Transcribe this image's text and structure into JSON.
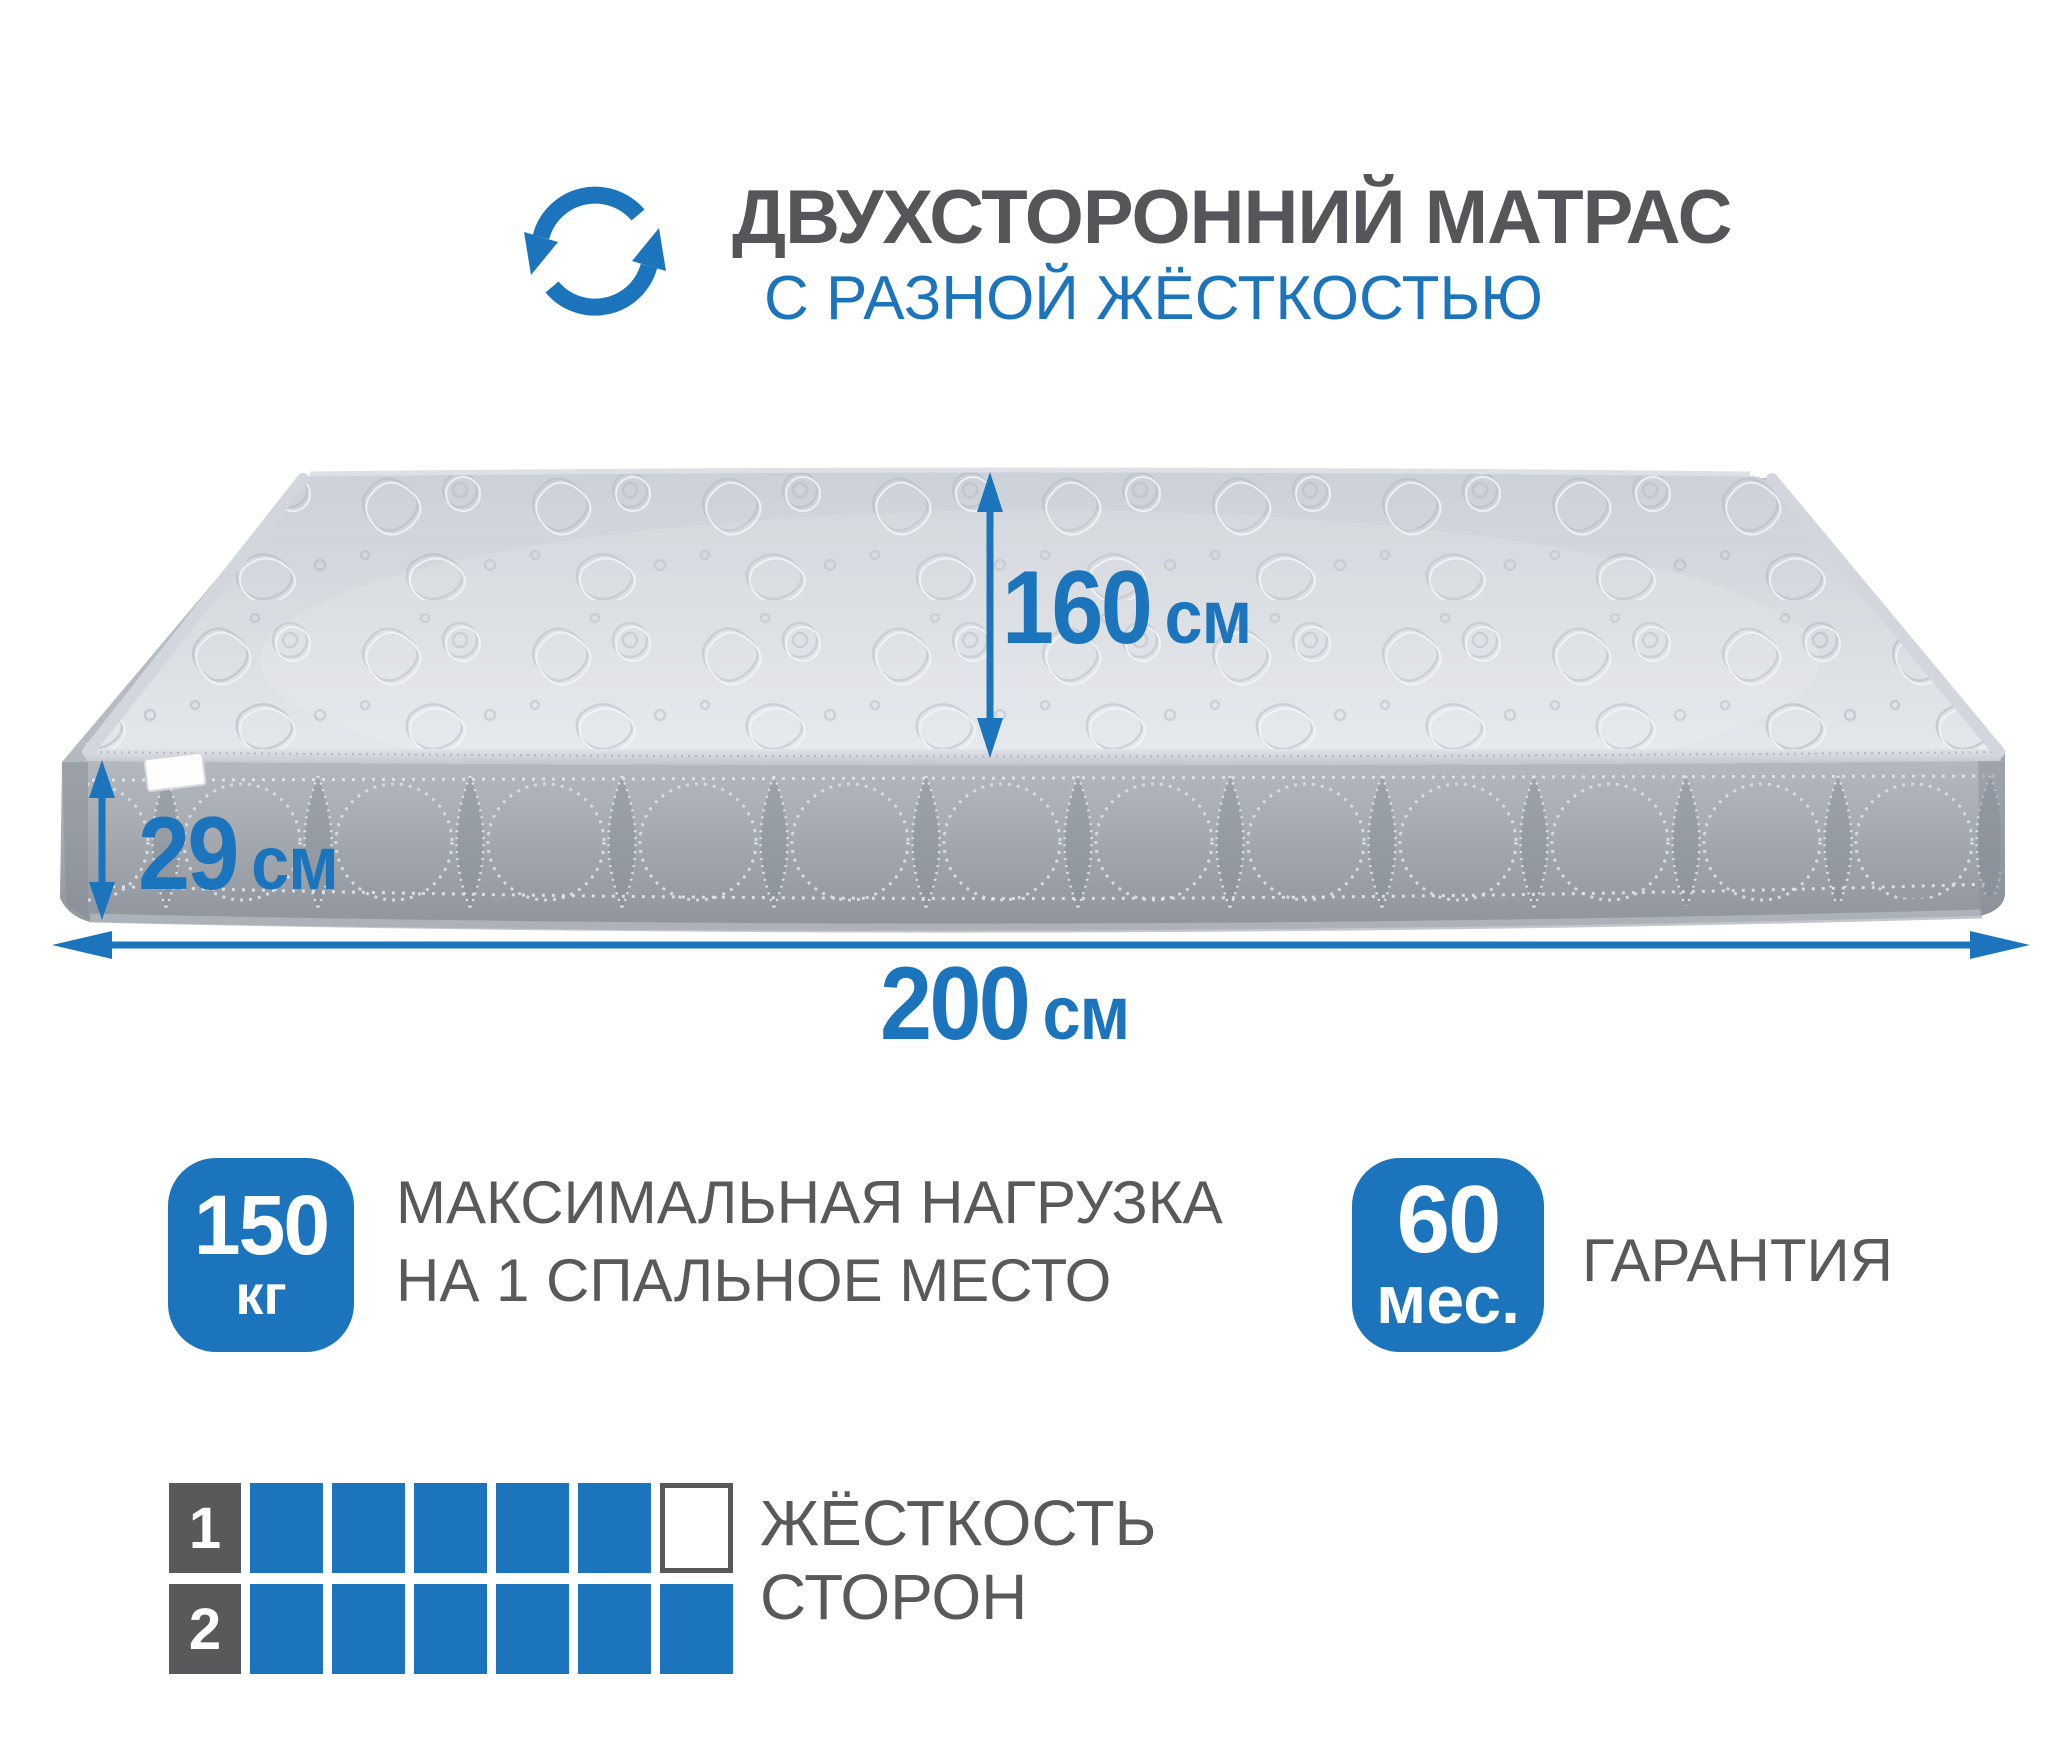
{
  "header": {
    "icon": "rotate-arrows-icon",
    "title": "ДВУХСТОРОННИЙ МАТРАС",
    "subtitle": "С РАЗНОЙ ЖЁСТКОСТЬЮ"
  },
  "dimensions": {
    "width": {
      "value": "160",
      "unit": "см"
    },
    "height": {
      "value": "29",
      "unit": "см"
    },
    "length": {
      "value": "200",
      "unit": "см"
    }
  },
  "badges": {
    "max_load": {
      "value": "150",
      "unit": "кг",
      "caption_line1": "МАКСИМАЛЬНАЯ НАГРУЗКА",
      "caption_line2": "НА 1 СПАЛЬНОЕ МЕСТО"
    },
    "warranty": {
      "value": "60",
      "unit": "мес.",
      "caption": "ГАРАНТИЯ"
    }
  },
  "firmness": {
    "caption_line1": "ЖЁСТКОСТЬ",
    "caption_line2": "СТОРОН",
    "scale_max": 6,
    "rows": [
      {
        "index": "1",
        "filled": 5
      },
      {
        "index": "2",
        "filled": 6
      }
    ]
  },
  "colors": {
    "accent_blue": "#1C75BC",
    "text_gray": "#58595B",
    "title_gray": "#545659",
    "mattress_top": "#DADEE3",
    "mattress_side": "#A6ABB2"
  }
}
